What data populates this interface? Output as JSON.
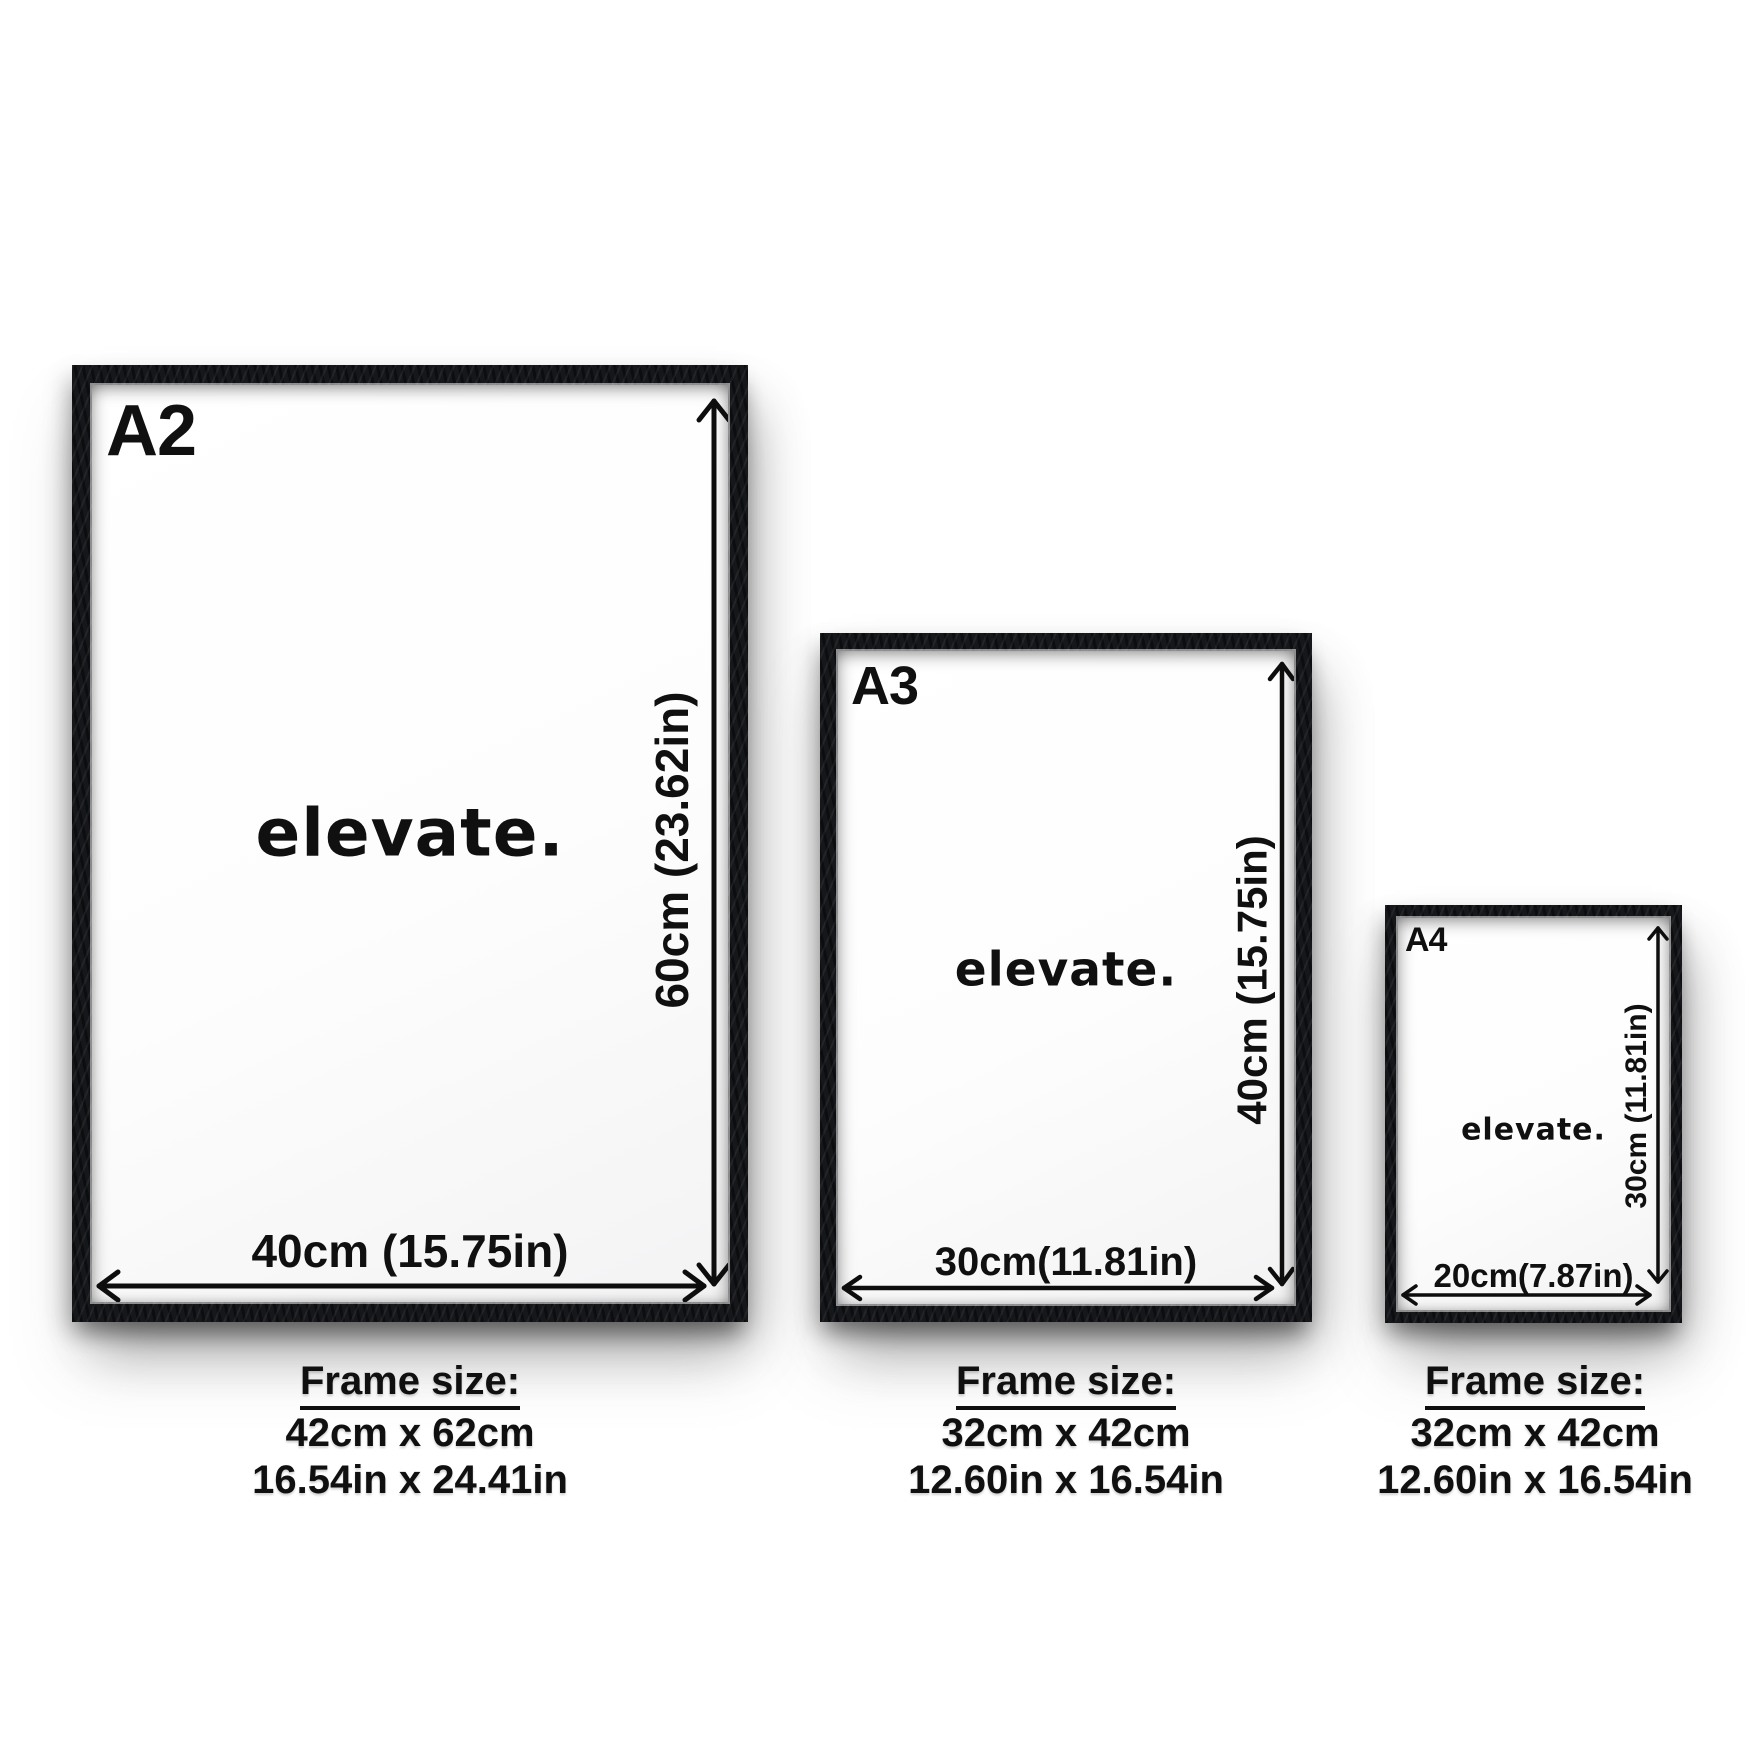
{
  "scene": {
    "background_color": "#ffffff",
    "frame_color": "#16171b",
    "text_color": "#101010",
    "description": "Poster frame size guide with three framed prints"
  },
  "frames": [
    {
      "label": "A2",
      "poster_text": "elevate.",
      "height_label": "60cm (23.62in)",
      "width_label": "40cm (15.75in)",
      "caption": {
        "title": "Frame size:",
        "size_cm": "42cm x 62cm",
        "size_in": "16.54in x 24.41in"
      }
    },
    {
      "label": "A3",
      "poster_text": "elevate.",
      "height_label": "40cm (15.75in)",
      "width_label": "30cm(11.81in)",
      "caption": {
        "title": "Frame size:",
        "size_cm": "32cm x 42cm",
        "size_in": "12.60in x 16.54in"
      }
    },
    {
      "label": "A4",
      "poster_text": "elevate.",
      "height_label": "30cm (11.81in)",
      "width_label": "20cm(7.87in)",
      "caption": {
        "title": "Frame size:",
        "size_cm": "32cm x 42cm",
        "size_in": "12.60in x 16.54in"
      }
    }
  ]
}
